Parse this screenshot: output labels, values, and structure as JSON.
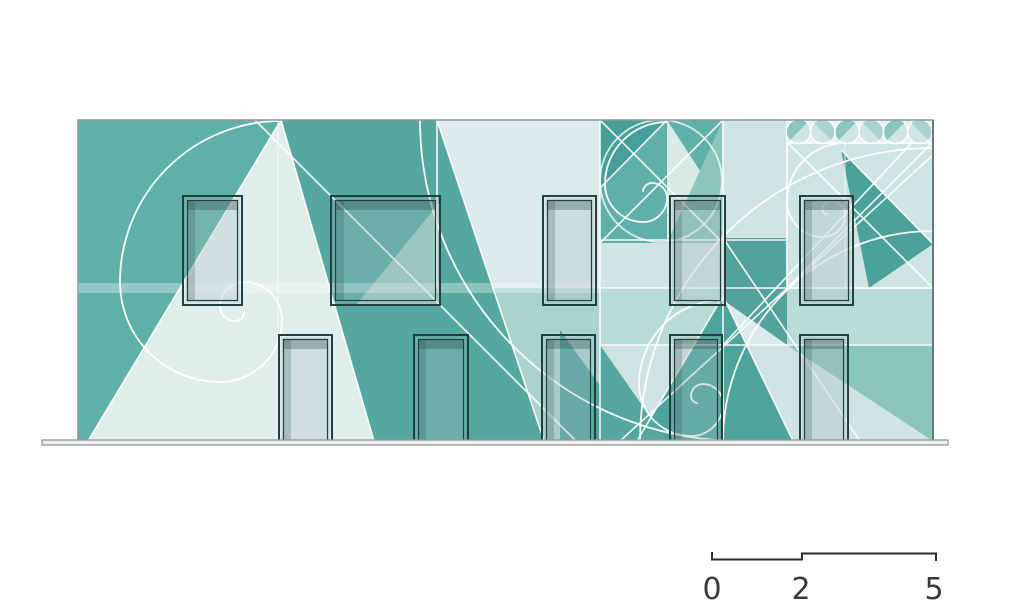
{
  "drawing": {
    "type": "building-elevation",
    "motifs": [
      "golden-spiral",
      "fibonacci-squares",
      "petal-medallion-band"
    ],
    "windows_upper_count": 5,
    "doors_lower_count": 5,
    "palette": {
      "teal_dark": "#479f99",
      "teal": "#5fb0a9",
      "teal_mid": "#8cc4be",
      "mint_light": "#a9d3ce",
      "mint_pale": "#cfe3e0",
      "mint_palest": "#dcebe9",
      "line_white": "#ffffff",
      "window_frame": "#23403c",
      "ground_gray": "#8f9b99",
      "text_gray": "#3a3a3a"
    }
  },
  "scale_bar": {
    "labels": [
      "0",
      "2",
      "5"
    ]
  }
}
